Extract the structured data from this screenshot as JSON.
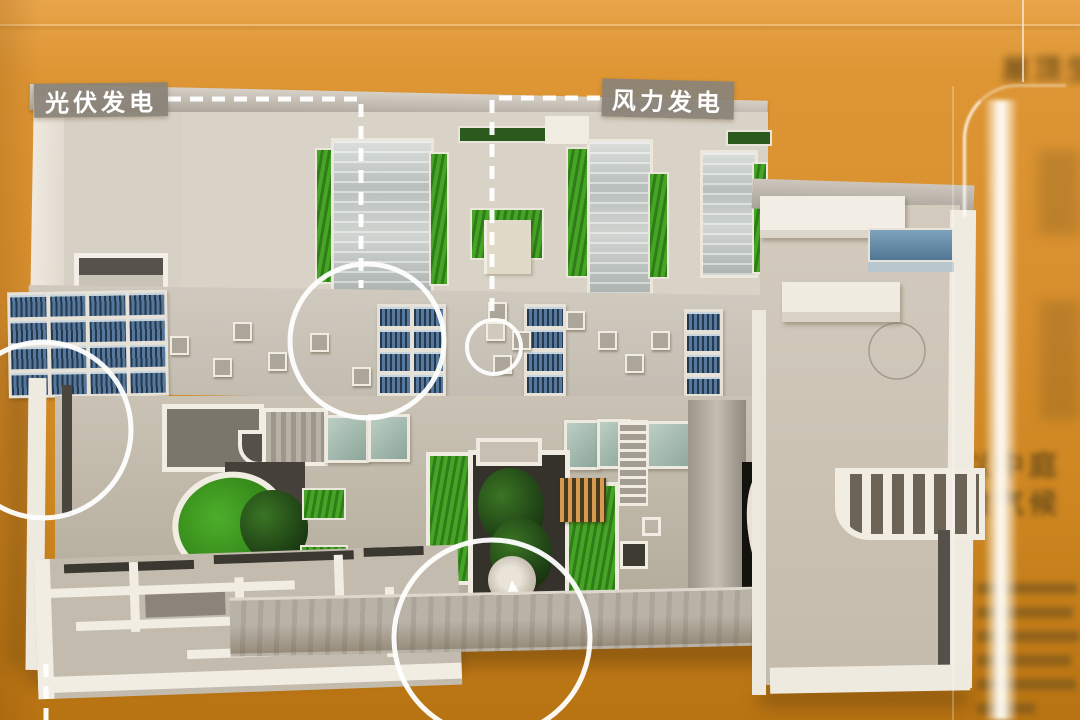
{
  "scene": {
    "description": "Museum display: architectural scale model of an eco-building with rooftop annotations, photographed top-down inside an acrylic case"
  },
  "annotations": {
    "pv_label": "光伏发电",
    "wind_label": "风力发电"
  },
  "poster": {
    "top_text": "屋顶生",
    "mid_line1": "以中庭",
    "mid_line2": "微气候"
  },
  "colors": {
    "background_orange": "#d78e2c",
    "solar_panel_blue": "#56789c",
    "greenery_green": "#3e9222",
    "canopy_teal": "#a9beb3",
    "model_gray": "#d8d2c6",
    "label_background": "#8a8277",
    "annotation_white": "#ffffff"
  }
}
